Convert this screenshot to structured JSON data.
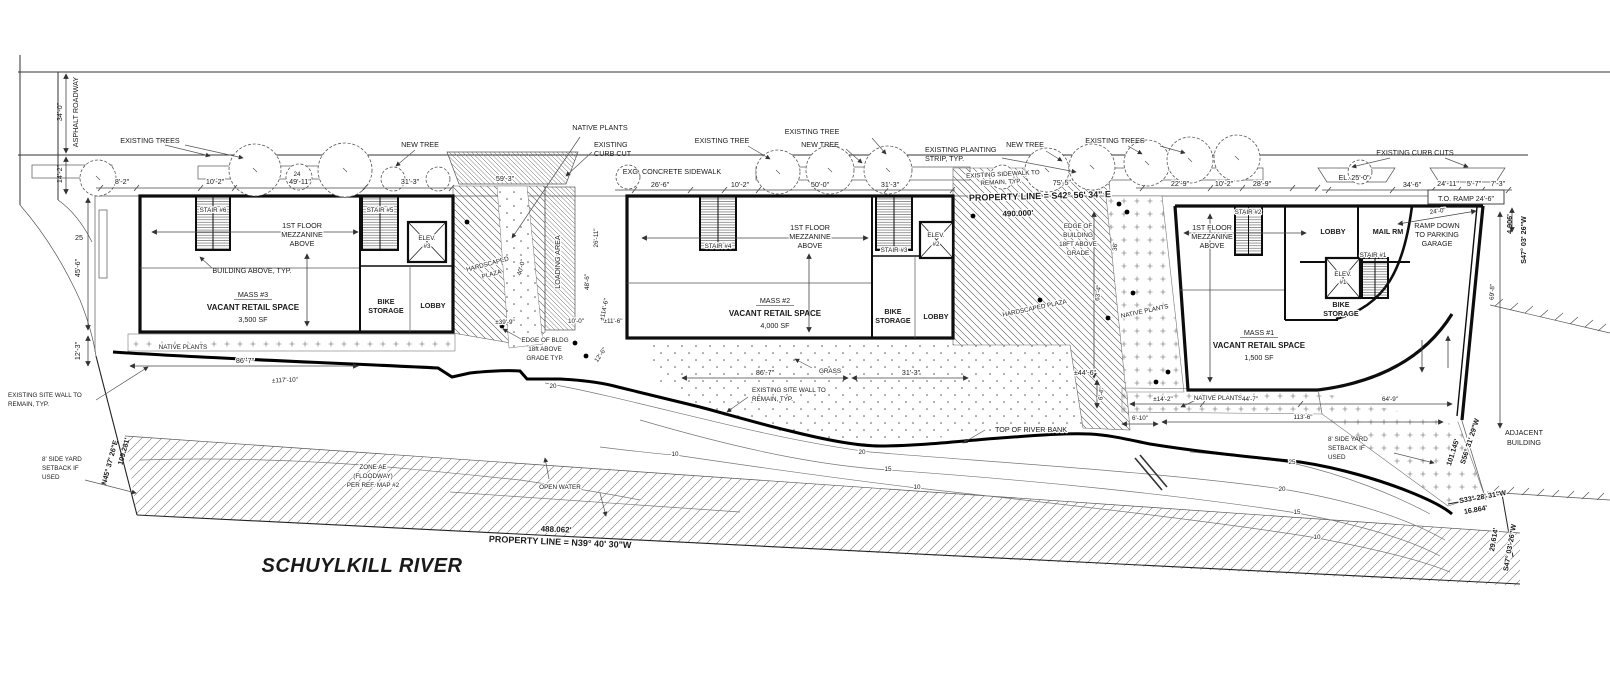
{
  "colors": {
    "ink": "#1a1a1a",
    "paper": "#ffffff"
  },
  "labels": {
    "asphalt_roadway": "ASPHALT ROADWAY",
    "d_34_0": "34'-0\"",
    "d_14_2": "14'-2\"",
    "existing_trees": "EXISTING TREES",
    "existing_tree": "EXISTING TREE",
    "new_tree": "NEW TREE",
    "d_8_2": "8'-2\"",
    "d_10_2": "10'-2\"",
    "d_49_11": "49'-11\"",
    "tree_tag": "24",
    "d_31_3": "31'-3\"",
    "d_59_3": "59'-3\"",
    "native_plants": "NATIVE PLANTS",
    "existing_l1": "EXISTING",
    "curb_cut_l2": "CURB CUT",
    "exg_sidewalk": "EXG. CONCRETE SIDEWALK",
    "d_26_6": "26'-6\"",
    "d_50_0": "50'-0\"",
    "eps_l1": "EXISTING PLANTING",
    "eps_l2": "STRIP, TYP.",
    "esw_l1": "EXISTING SIDEWALK TO",
    "esw_l2": "REMAIN, TYP.",
    "pl_top": "PROPERTY LINE = S42° 56' 34\" E",
    "d_490": "490.000'",
    "d_75_5": "75'-5\"",
    "edge2_l1": "EDGE OF",
    "edge2_l2": "BUILDING",
    "edge2_l3": "18FT ABOVE",
    "edge2_l4": "GRADE",
    "d_22_9": "22'-9\"",
    "d_28_9": "28'-9\"",
    "curb_cuts": "EXISTING CURB CUTS",
    "d_el_25": "EL. 25'-0\"",
    "d_34_6": "34'-6\"",
    "d_24_11": "24'-11\"",
    "d_5_7": "5'-7\"",
    "d_7_3": "7'-3\"",
    "to_ramp": "T.O. RAMP 24'-6\"",
    "d_4_906": "4.906'",
    "s47": "S47° 03' 26\"W",
    "d_69_8": "69'-8\"",
    "ramp_l1": "RAMP DOWN",
    "ramp_l2": "TO PARKING",
    "ramp_l3": "GARAGE",
    "d_24_0": "24'-0\"",
    "stair6": "STAIR #6",
    "stair5": "STAIR #5",
    "stair4": "STAIR #4",
    "stair3": "STAIR #3",
    "stair2": "STAIR #2",
    "stair1": "STAIR #1",
    "elev": "ELEV.",
    "e3": "#3",
    "e2": "#2",
    "e1": "#1",
    "mezz_l1": "1ST FLOOR",
    "mezz_l2": "MEZZANINE",
    "mezz_l3": "ABOVE",
    "building_above": "BUILDING ABOVE, TYP.",
    "m3_name": "MASS #3",
    "m2_name": "MASS #2",
    "m1_name": "MASS #1",
    "vacant": "VACANT RETAIL SPACE",
    "m3_sf": "3,500 SF",
    "m2_sf": "4,000 SF",
    "m1_sf": "1,500 SF",
    "bike_l1": "BIKE",
    "bike_l2": "STORAGE",
    "lobby": "LOBBY",
    "mail_rm": "MAIL RM",
    "hp_l1": "HARDSCAPED",
    "hp_l2": "PLAZA",
    "hp_full": "HARDSCAPED PLAZA",
    "loading": "LOADING AREA",
    "d_40_0": "40'-0\"",
    "d_26_11": "26'-11\"",
    "d_48_6": "48'-6\"",
    "d_39_9": "±39'-9\"",
    "d_10_0": "10'-0\"",
    "d_11_6": "±11'-6\"",
    "d_12_6": "12'-6\"",
    "edge1_l1": "EDGE OF BLDG",
    "edge1_l2": "18ft ABOVE",
    "edge1_l3": "GRADE TYP.",
    "d_114_6": "±114'-6\"",
    "grass": "GRASS",
    "d_86_7": "86'-7\"",
    "d_117_10": "±117'-10\"",
    "wall_l1": "EXISTING SITE WALL TO",
    "wall_l2": "REMAIN, TYP.",
    "d_44_6": "±44'-6\"",
    "d_63_4": "63'-4\"",
    "d_36": "36'",
    "d_6_4": "6'-4\"",
    "d_6_10": "6'-10\"",
    "d_14_2b": "±14'-2\"",
    "d_44_7": "44'-7\"",
    "d_113_6": "113'-6\"",
    "d_64_9": "64'-9\"",
    "top_bank": "TOP OF RIVER BANK",
    "zone_l1": "ZONE AE",
    "zone_l2": "(FLOODWAY)",
    "zone_l3": "PER REF. MAP #2",
    "open_water": "OPEN WATER",
    "d_488": "488.062'",
    "pl_bottom": "PROPERTY LINE = N39° 40' 30\"W",
    "river_title": "SCHUYLKILL RIVER",
    "sy_l1": "8' SIDE YARD",
    "sy_l2": "SETBACK IF",
    "sy_l3": "USED",
    "n45": "N45° 37' 26\"E",
    "d_109": "109.281'",
    "d_101": "101.145'",
    "s56": "S56° 31' 29\"W",
    "adj_l1": "ADJACENT",
    "adj_l2": "BUILDING",
    "s33": "S33° 28' 31\"W",
    "d_16_864": "16.864'",
    "d_29_614": "29.614'",
    "c10": "10",
    "c15": "15",
    "c20": "20",
    "c25": "25",
    "d_45_6": "45'-6\"",
    "d_12_3": "12'-3\""
  }
}
